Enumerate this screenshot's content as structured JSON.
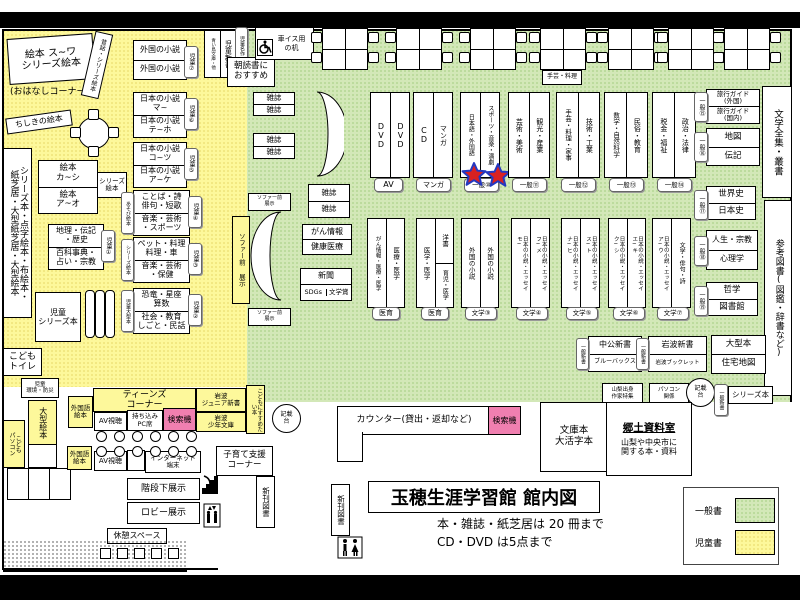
{
  "header": {
    "title": "玉穂生涯学習館 館内図",
    "note_books": "本・雑誌・紙芝居は 20 冊まで",
    "note_av": "CD・DVD は5点まで"
  },
  "legend": {
    "general_label": "一般書",
    "children_label": "児童書",
    "colors": {
      "general": "#d3e8b8",
      "children": "#fdf89b",
      "search_pink": "#f07fb0"
    }
  },
  "kids": {
    "ehon_suwa": "絵本 ス~ワ\nシリーズ絵本",
    "ohanashi": "(おはなしコーナー)",
    "mukashibanashi": "昔話・シリーズ絵本",
    "chishiki_ehon": "ちしきの絵本",
    "gaikoku_1": "外国の小説",
    "gaikoku_2": "外国の小説",
    "badge_7": "児童⑦",
    "aoitori": "青い鳥文庫・他",
    "jido_shinsho": "児童新書",
    "jido_meisaku": "児童名作",
    "asadoku": "朝読書に\nおすすめ",
    "nihon_1a": "日本の小説\nマ~",
    "nihon_1b": "日本の小説\nテ~ホ",
    "badge_6": "児童⑥",
    "nihon_2a": "日本の小説\nコ~ツ",
    "nihon_2b": "日本の小説\nア~ケ",
    "badge_5": "児童⑤",
    "tall_left": "シリーズ本・点字絵本・布絵本・\n紙芝居・大型紙芝居・大型絵本",
    "ehon_ka": "絵本\nカ~シ",
    "ehon_a": "絵本\nア~オ",
    "series_ehon_tag": "シリーズ\n絵本",
    "kotoba_a": "ことば・詩\n俳句・短歌",
    "kotoba_b": "音楽・芸術\n・スポーツ",
    "asobi_ehon": "あそび絵本",
    "badge_4": "児童④",
    "chiri_a": "地理・伝記\n・歴史",
    "chiri_b": "百科事典・\n占い・宗教",
    "badge_1": "児童①",
    "pet_a": "ペット・料理\n料理・車",
    "pet_b": "音楽・芸術\n・保健",
    "series_ehon_side": "シリーズ絵本",
    "badge_3": "児童③",
    "kyoryu_a": "恐竜・星座\n算数",
    "kyoryu_b": "社会・教育\nしごと・民話",
    "jido_ogata": "児童大型本",
    "badge_2": "児童②",
    "jido_series": "児童\nシリーズ本",
    "kodomo_toilet": "こども\nトイレ",
    "jido_kankyo": "児童\n環境・防災",
    "ogata_ehon": "大型絵本",
    "kodomo_pc": "こども\nパソコン"
  },
  "teens": {
    "header": "ティーンズ\nコーナー",
    "gaikokugo_ehon_1": "外国語\n絵本",
    "av_1": "AV視聴",
    "pc_seat": "持ち込み\nPC席",
    "kensakuki": "検索機",
    "iwanami_junior": "岩波\nジュニア新書",
    "iwanami_shonen": "岩波\n少年文庫",
    "kodomo_susume": "こどもにすすめたい本",
    "gaikokugo_ehon_2": "外国語\n絵本",
    "av_2": "AV視聴",
    "internet": "インターネット\n端末",
    "kosodate": "子育て支援\nコーナー"
  },
  "facilities": {
    "kaidan": "階段下展示",
    "lobby": "ロビー展示",
    "kyukei": "休憩スペース",
    "shinkan_1": "新刊図書",
    "shinkan_2": "新刊図書",
    "counter": "カウンター(貸出・返却など)",
    "kensakuki": "検索機",
    "kisaidai_1": "記載\n台",
    "kisaidai_2": "記載\n台",
    "wheelchair_desk": "車イス用\nの机"
  },
  "general": {
    "zasshi": "雑誌",
    "dvd": "DVD",
    "tag_av": "AV",
    "cd": "CD",
    "manga": "マンガ",
    "tag_manga": "マンガ",
    "lang": "日本語・外国語",
    "sports": "スポーツ・音楽・演劇",
    "tag_10": "一般⑩",
    "geijutsu": "芸術・美術",
    "kanko": "観光・産業",
    "tag_11": "一般⑪",
    "shugei": "手芸・料理・家事",
    "gijutsu": "技術・工業",
    "tag_12": "一般⑫",
    "sugaku": "数学・自然科学",
    "minzoku": "民俗・教育",
    "tag_13": "一般⑬",
    "zeikin": "税金・福祉",
    "seiji": "政治・法律",
    "tag_14": "一般⑭",
    "shugei_mini": "手芸・料理",
    "ryoko_a": "旅行ガイド\n(外国)",
    "ryoko_b": "旅行ガイド\n(国内)",
    "tag_15": "一般⑮",
    "chizu": "地図",
    "denki": "伝記",
    "tag_16": "一般⑯",
    "sekaishi": "世界史",
    "nihonshi": "日本史",
    "tag_17": "一般⑰",
    "jinsei": "人生・宗教",
    "shinri": "心理学",
    "tag_18": "一般⑱",
    "tetsugaku": "哲学",
    "toshokan": "図書館",
    "tag_19": "一般⑲",
    "zenshu": "文学全集・叢書",
    "sanko": "参考図書(図鑑・辞書など)",
    "sofa_front": "ソファー前\n展示",
    "sofa_front_v": "ソファー前 展示",
    "gan_joho": "がん情報",
    "kenko": "健康医療",
    "shinbun": "新聞",
    "sdgs": "SDGs",
    "bungakusho": "文学賞",
    "med1_a": "がん情報・医療・医学",
    "med1_b": "医療・医学",
    "tag_med1": "医育",
    "med2_a": "医学・医学",
    "med2_b_top": "洋書",
    "med2_b_bottom": "育児・医学",
    "tag_med2": "医育",
    "fg3_a": "外国の小説",
    "fg3_b": "外国の小説",
    "tag_f3": "文学③",
    "f4_a": "日本の小説・エッセイ\nモ~",
    "f4_b": "日本の小説・エッセイ\nフ~メ",
    "tag_f4": "文学④",
    "f5_a": "日本の小説・エッセイ\nナ~ヒ",
    "f5_b": "日本の小説・エッセイ\nス~ト",
    "tag_f5": "文学⑤",
    "f6_a": "日本の小説・エッセイ\nク~シ",
    "f6_b": "日本の小説・エッセイ\nエ~キ",
    "tag_f6": "文学⑥",
    "f7_a": "日本の小説・エッセイ\nア~ウ",
    "f7_b": "文学・俳句・詩",
    "tag_f7": "文学⑦",
    "chuko": "中公新書",
    "bluebacks": "ブルーバックス",
    "tag_shinsho_1": "一般新書",
    "iwanami_shinsho": "岩波新書",
    "iwanami_booklet": "岩波ブックレット",
    "tag_shinsho_2": "一般新書",
    "ogata_bon": "大型本",
    "jutaku_chizu": "住宅地図",
    "yamanashi": "山梨出身\n作家特集",
    "pasokon": "パソコン\n関係",
    "tag_shinsho_3": "一般新書",
    "series_bon": "シリーズ本",
    "bunkobon": "文庫本\n大活字本",
    "kyodo_title": "郷土資料室",
    "kyodo_body": "山梨や中央市に\n関する本・資料"
  }
}
